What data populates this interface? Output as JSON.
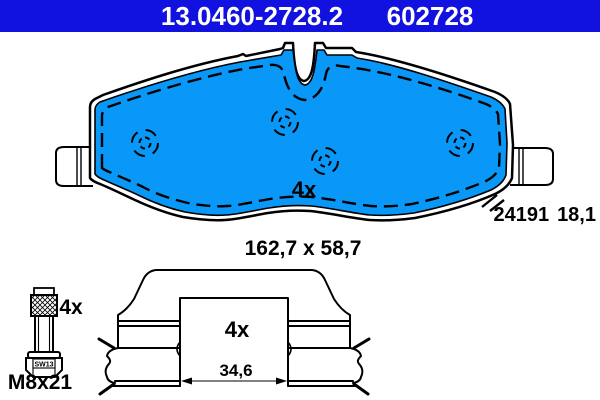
{
  "header": {
    "part_number": "13.0460-2728.2",
    "oem_number": "602728"
  },
  "pad": {
    "quantity": "4x",
    "wva_number": "24191",
    "thickness_mm": "18,1",
    "dimensions_mm": "162,7 x 58,7"
  },
  "bolt": {
    "quantity": "4x",
    "wrench_size": "SW13",
    "thread_size": "M8x21"
  },
  "clip": {
    "quantity": "4x",
    "inner_width_mm": "34,6"
  },
  "colors": {
    "header_bg": "#1111e0",
    "pad_fill": "#0997f8",
    "line": "#000000"
  }
}
